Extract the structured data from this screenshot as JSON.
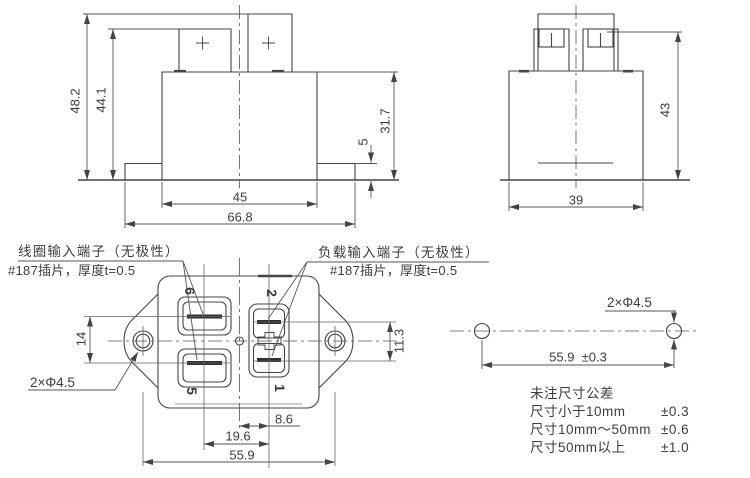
{
  "front_view": {
    "dim_total_height": "48.2",
    "dim_terminal_height": "44.1",
    "dim_body_height": "31.7",
    "dim_flange_thickness": "5",
    "dim_body_width": "45",
    "dim_flange_width": "66.8"
  },
  "side_view": {
    "dim_height": "43",
    "dim_width": "39"
  },
  "bottom_view": {
    "coil_label": {
      "line1": "线圈输入端子（无极性）",
      "line2": "#187插片，厚度t=0.5"
    },
    "load_label": {
      "line1": "负载输入端子（无极性）",
      "line2": "#187插片，厚度t=0.5"
    },
    "hole_note": "2×Φ4.5",
    "terminals": {
      "coil_top": "6",
      "coil_bottom": "5",
      "load_top": "2",
      "load_bottom": "1"
    },
    "dim_coil_terminal_pitch": "14",
    "dim_load_terminal_pitch": "11.3",
    "dim_center_to_load": "8.6",
    "dim_coil_to_load": "19.6",
    "dim_mounting_hole_span": "55.9"
  },
  "mounting_view": {
    "hole_note": "2×Φ4.5",
    "dim_hole_span": "55.9  ±0.3"
  },
  "tolerance_table": {
    "title": "未注尺寸公差",
    "rows": [
      {
        "range": "尺寸小于10mm",
        "tolerance": "±0.3"
      },
      {
        "range": "尺寸10mm～50mm",
        "tolerance": "±0.6"
      },
      {
        "range": "尺寸50mm以上",
        "tolerance": "±1.0"
      }
    ]
  },
  "colors": {
    "background": "#ffffff",
    "line": "#444444",
    "text": "#3d3d3d"
  }
}
